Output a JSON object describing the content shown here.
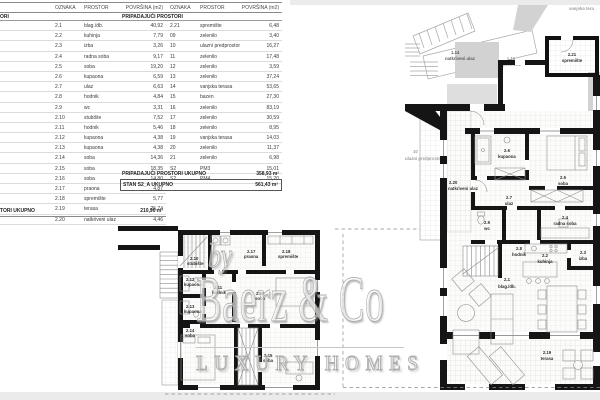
{
  "tables": {
    "main": {
      "headers": [
        "OZNAKA",
        "PROSTOR",
        "POVRŠINA (m2)"
      ],
      "section_fragment": "ORI",
      "rows": [
        [
          "2.1",
          "blag./db.",
          "40,92"
        ],
        [
          "2.2",
          "kuhinja",
          "7,79"
        ],
        [
          "2.3",
          "izba",
          "3,26"
        ],
        [
          "2.4",
          "radna soba",
          "9,17"
        ],
        [
          "2.5",
          "soba",
          "19,20"
        ],
        [
          "2.6",
          "kupaona",
          "6,59"
        ],
        [
          "2.7",
          "ulaz",
          "6,63"
        ],
        [
          "2.8",
          "hodnik",
          "4,84"
        ],
        [
          "2.9",
          "wc",
          "3,31"
        ],
        [
          "2.10",
          "stubište",
          "7,52"
        ],
        [
          "2.11",
          "hodnik",
          "5,46"
        ],
        [
          "2.12",
          "kupaona",
          "4,38"
        ],
        [
          "2.13",
          "kupaona",
          "4,38"
        ],
        [
          "2.14",
          "soba",
          "14,36"
        ],
        [
          "2.15",
          "soba",
          "18,35"
        ],
        [
          "2.16",
          "soba",
          "14,80"
        ],
        [
          "2.17",
          "praona",
          "4,87"
        ],
        [
          "2.18",
          "spremište",
          "5,77"
        ],
        [
          "2.19",
          "terasa",
          "25,74"
        ],
        [
          "2.20",
          "natkriveni ulaz",
          "4,46"
        ]
      ],
      "total_label_fragment": "TORI UKUPNO",
      "total_value": "210,90 m²"
    },
    "associated": {
      "headers": [
        "OZNAKA",
        "PROSTOR",
        "POVRŠINA (m2)"
      ],
      "section_label": "PRIPADAJUĆI PROSTORI",
      "rows": [
        [
          "2.21",
          "spremište",
          "6,48"
        ],
        [
          "09",
          "zelenilo",
          "3,40"
        ],
        [
          "10",
          "ulazni predprostor",
          "16,27"
        ],
        [
          "11",
          "zelenilo",
          "17,48"
        ],
        [
          "12",
          "zelenilo",
          "3,59"
        ],
        [
          "13",
          "zelenilo",
          "37,24"
        ],
        [
          "14",
          "vanjska terasa",
          "53,65"
        ],
        [
          "15",
          "bazen",
          "27,30"
        ],
        [
          "16",
          "zelenilo",
          "83,19"
        ],
        [
          "17",
          "zelenilo",
          "30,59"
        ],
        [
          "18",
          "zelenilo",
          "8,95"
        ],
        [
          "19",
          "vanjska terasa",
          "14,03"
        ],
        [
          "20",
          "zelenilo",
          "11,37"
        ],
        [
          "21",
          "zelenilo",
          "6,98"
        ],
        [
          "S2",
          "PM3",
          "15,01"
        ],
        [
          "S2",
          "PM4",
          "15,20"
        ]
      ],
      "total_label": "PRIPADAJUĆI PROSTORI UKUPNO",
      "total_value": "358,93 m²",
      "grand_total_label": "STAN S2_A UKUPNO",
      "grand_total_value": "561,43 m²"
    }
  },
  "watermark": {
    "by": "by",
    "name": "Baerz & Co",
    "tagline": "LUXURY HOMES"
  },
  "plans": {
    "upper": {
      "labels": {
        "stubiste": {
          "no": "2.10",
          "name": "stubište"
        },
        "praona": {
          "no": "2.17",
          "name": "praona"
        },
        "spremiste": {
          "no": "2.18",
          "name": "spremište"
        },
        "kupaona1": {
          "no": "2.12",
          "name": "kupaona"
        },
        "hodnik": {
          "no": "2.11",
          "name": "hodnik"
        },
        "soba_mid": {
          "no": "2.16",
          "name": "soba"
        },
        "kupaona2": {
          "no": "2.13",
          "name": "kupaona"
        },
        "soba_left": {
          "no": "2.14",
          "name": "soba"
        },
        "soba_right": {
          "no": "2.15",
          "name": "soba"
        }
      }
    },
    "main": {
      "labels": {
        "spremiste221": {
          "no": "2.21",
          "name": "spremište"
        },
        "natkriveni": {
          "no": "2.20",
          "name": "natkriveni ulaz"
        },
        "kupaona": {
          "no": "2.6",
          "name": "kupaona"
        },
        "soba": {
          "no": "2.5",
          "name": "soba"
        },
        "ulaz": {
          "no": "2.7",
          "name": "ulaz"
        },
        "wc": {
          "no": "2.9",
          "name": "wc"
        },
        "radna": {
          "no": "2.4",
          "name": "radna soba"
        },
        "hodnik": {
          "no": "2.8",
          "name": "hodnik"
        },
        "kuhinja": {
          "no": "2.2",
          "name": "kuhinja"
        },
        "izba": {
          "no": "2.3",
          "name": "izba"
        },
        "blag": {
          "no": "2.1",
          "name": "blag./db."
        },
        "terasa": {
          "no": "2.19",
          "name": "terasa"
        }
      }
    },
    "site": {
      "vanjska_terasa": "vanjska tera",
      "spremiste_no": "1.15",
      "spremiste": "spremište",
      "ulaz_no": "1.14",
      "ulaz": "natkriveni ulaz",
      "predprostor_no": "10",
      "predprostor": "ulazni predprostor"
    }
  }
}
